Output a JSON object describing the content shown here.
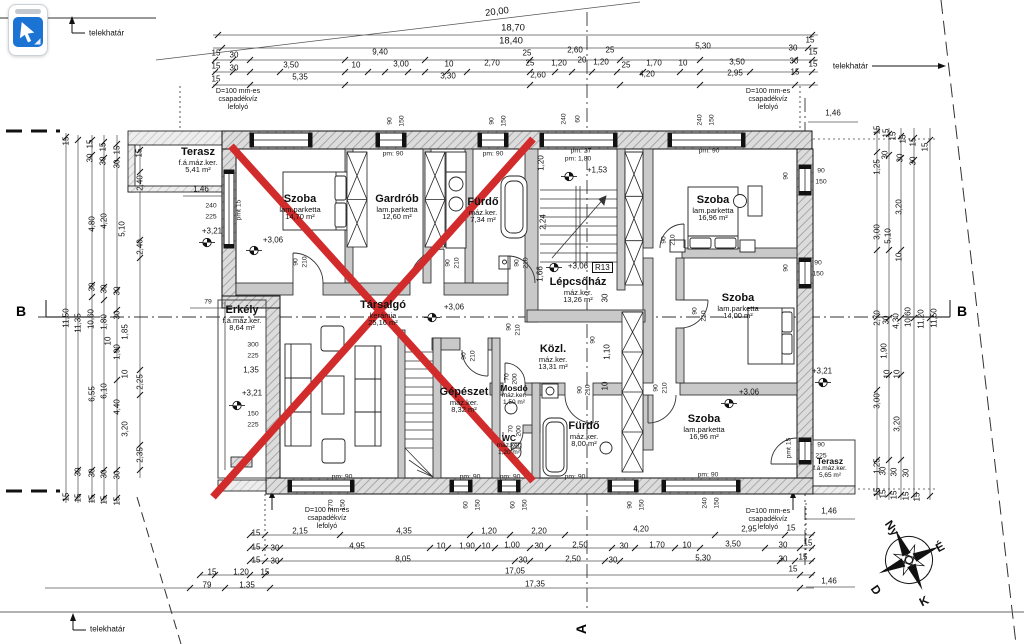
{
  "tool_button": {
    "tool": "cursor"
  },
  "labels": {
    "telekhatar": "telekhatár",
    "drain_lines": [
      "D=100 mm-es",
      "csapadékvíz",
      "lefolyó"
    ],
    "section_b": "B",
    "section_a": "A",
    "stair_code": "R13"
  },
  "compass": {
    "w": "Ny",
    "n": "É",
    "s": "D",
    "e": "K"
  },
  "colors": {
    "redx": "#d22b2b",
    "tool_blue": "#1b74d3"
  },
  "rooms": [
    {
      "n": "Terasz",
      "f": "f.á.máz.ker.",
      "a": "5,41 m²",
      "x": 198,
      "y": 147,
      "cls": ""
    },
    {
      "n": "Szoba",
      "f": "lam.parketta",
      "a": "14,70 m²",
      "x": 300,
      "y": 194,
      "cls": ""
    },
    {
      "n": "Gardrób",
      "f": "lam.parketta",
      "a": "12,60 m²",
      "x": 397,
      "y": 194,
      "cls": ""
    },
    {
      "n": "Fürdő",
      "f": "máz.ker.",
      "a": "7,34 m²",
      "x": 483,
      "y": 197,
      "cls": ""
    },
    {
      "n": "Szoba",
      "f": "lam.parketta",
      "a": "16,96 m²",
      "x": 713,
      "y": 195,
      "cls": ""
    },
    {
      "n": "Lépcsőház",
      "f": "máz.ker.",
      "a": "13,26 m²",
      "x": 578,
      "y": 277,
      "cls": ""
    },
    {
      "n": "Szoba",
      "f": "lam.parketta",
      "a": "14,00 m²",
      "x": 738,
      "y": 293,
      "cls": ""
    },
    {
      "n": "Erkély",
      "f": "f.á.máz.ker.",
      "a": "8,64 m²",
      "x": 242,
      "y": 305,
      "cls": ""
    },
    {
      "n": "Társalgó",
      "f": "kerámia",
      "a": "25,16 m²",
      "x": 383,
      "y": 300,
      "cls": ""
    },
    {
      "n": "Közl.",
      "f": "máz.ker.",
      "a": "13,31 m²",
      "x": 553,
      "y": 344,
      "cls": ""
    },
    {
      "n": "Gépészet",
      "f": "máz.ker.",
      "a": "8,32 m²",
      "x": 464,
      "y": 387,
      "cls": ""
    },
    {
      "n": "Mosdó",
      "f": "máz.ker.",
      "a": "1,50 m²",
      "x": 514,
      "y": 384,
      "cls": "small"
    },
    {
      "n": "WC",
      "f": "máz.ker.",
      "a": "1,20 m²",
      "x": 509,
      "y": 434,
      "cls": "small"
    },
    {
      "n": "Fürdő",
      "f": "máz.ker.",
      "a": "8,00 m²",
      "x": 584,
      "y": 421,
      "cls": ""
    },
    {
      "n": "Szoba",
      "f": "lam.parketta",
      "a": "16,96 m²",
      "x": 704,
      "y": 414,
      "cls": ""
    },
    {
      "n": "Terasz",
      "f": "f.á.máz.ker.",
      "a": "5,65 m²",
      "x": 830,
      "y": 457,
      "cls": "small"
    }
  ],
  "elevations": [
    {
      "t": "+3,21",
      "x": 212,
      "y": 231
    },
    {
      "t": "+3,06",
      "x": 273,
      "y": 240
    },
    {
      "t": "+1,53",
      "x": 597,
      "y": 170
    },
    {
      "t": "+3,06",
      "x": 578,
      "y": 266
    },
    {
      "t": "+3,06",
      "x": 454,
      "y": 307
    },
    {
      "t": "+3,21",
      "x": 252,
      "y": 393
    },
    {
      "t": "+3,06",
      "x": 749,
      "y": 392
    },
    {
      "t": "+3,21",
      "x": 822,
      "y": 371
    }
  ],
  "elev_markers": [
    [
      207,
      245
    ],
    [
      254,
      253
    ],
    [
      569,
      179
    ],
    [
      554,
      270
    ],
    [
      432,
      320
    ],
    [
      237,
      408
    ],
    [
      729,
      406
    ],
    [
      823,
      385
    ]
  ],
  "drains": [
    [
      238,
      88
    ],
    [
      768,
      88
    ],
    [
      327,
      507
    ],
    [
      768,
      508
    ]
  ],
  "dims": [
    [
      "20,00",
      497,
      12,
      -7,
      "big"
    ],
    [
      "18,70",
      513,
      28,
      0,
      "big"
    ],
    [
      "18,40",
      511,
      41,
      0,
      "big"
    ],
    [
      "15",
      216,
      53
    ],
    [
      "30",
      234,
      55
    ],
    [
      "9,40",
      380,
      52
    ],
    [
      "25",
      527,
      53
    ],
    [
      "2,60",
      575,
      50
    ],
    [
      "25",
      610,
      50
    ],
    [
      "5,30",
      703,
      46
    ],
    [
      "30",
      793,
      48
    ],
    [
      "15",
      810,
      40
    ],
    [
      "15",
      813,
      52
    ],
    [
      "15",
      216,
      66
    ],
    [
      "30",
      234,
      68
    ],
    [
      "3,50",
      291,
      65
    ],
    [
      "10",
      356,
      65
    ],
    [
      "3,00",
      401,
      64
    ],
    [
      "10",
      449,
      64
    ],
    [
      "2,70",
      492,
      63
    ],
    [
      "25",
      530,
      63
    ],
    [
      "1,20",
      559,
      63
    ],
    [
      "20",
      582,
      60
    ],
    [
      "1,20",
      601,
      62
    ],
    [
      "25",
      626,
      65
    ],
    [
      "1,70",
      654,
      63
    ],
    [
      "10",
      683,
      63
    ],
    [
      "3,50",
      737,
      62
    ],
    [
      "30",
      794,
      61
    ],
    [
      "15",
      813,
      64
    ],
    [
      "15",
      216,
      79
    ],
    [
      "5,35",
      300,
      77
    ],
    [
      "3,30",
      448,
      76
    ],
    [
      "2,60",
      538,
      75
    ],
    [
      "4,20",
      647,
      74
    ],
    [
      "2,95",
      735,
      73
    ],
    [
      "15",
      795,
      72
    ],
    [
      "1,46",
      833,
      113
    ],
    [
      "15",
      66,
      141,
      -90
    ],
    [
      "15",
      90,
      144,
      -90
    ],
    [
      "15",
      103,
      147,
      -90
    ],
    [
      "15",
      117,
      150,
      -90
    ],
    [
      "15",
      139,
      153,
      -90
    ],
    [
      "30",
      90,
      158,
      -90
    ],
    [
      "30",
      103,
      161,
      -90
    ],
    [
      "30",
      117,
      164,
      -90
    ],
    [
      "2,40",
      140,
      183,
      -90
    ],
    [
      "4,80",
      92,
      224,
      -90
    ],
    [
      "4,20",
      104,
      221,
      -90
    ],
    [
      "5,10",
      122,
      229,
      -90
    ],
    [
      "2,40",
      140,
      247,
      -90
    ],
    [
      "30",
      92,
      287,
      -90
    ],
    [
      "30",
      104,
      289,
      -90
    ],
    [
      "30",
      117,
      291,
      -90
    ],
    [
      "11,50",
      66,
      318,
      -90
    ],
    [
      "11,35",
      78,
      323,
      -90
    ],
    [
      "10,60",
      91,
      319,
      -90
    ],
    [
      "1,80",
      104,
      322,
      -90
    ],
    [
      "30",
      117,
      315,
      -90
    ],
    [
      "1,85",
      125,
      332,
      -90
    ],
    [
      "10",
      108,
      341,
      -90
    ],
    [
      "1,90",
      117,
      352,
      -90
    ],
    [
      "10",
      125,
      374,
      -90
    ],
    [
      "6,55",
      92,
      394,
      -90
    ],
    [
      "6,10",
      104,
      391,
      -90
    ],
    [
      "4,40",
      117,
      407,
      -90
    ],
    [
      "3,20",
      125,
      429,
      -90
    ],
    [
      "2,25",
      140,
      382,
      -90
    ],
    [
      "2,35",
      140,
      455,
      -90
    ],
    [
      "30",
      78,
      472,
      -90
    ],
    [
      "30",
      92,
      473,
      -90
    ],
    [
      "30",
      104,
      474,
      -90
    ],
    [
      "30",
      117,
      475,
      -90
    ],
    [
      "15",
      66,
      497,
      -90
    ],
    [
      "15",
      78,
      498,
      -90
    ],
    [
      "15",
      92,
      499,
      -90
    ],
    [
      "15",
      104,
      500,
      -90
    ],
    [
      "15",
      117,
      501,
      -90
    ],
    [
      "15",
      877,
      130,
      -90
    ],
    [
      "15",
      886,
      133,
      -90
    ],
    [
      "15",
      893,
      136,
      -90
    ],
    [
      "15",
      903,
      139,
      -90
    ],
    [
      "15",
      913,
      142,
      -90
    ],
    [
      "15",
      925,
      147,
      -90
    ],
    [
      "30",
      885,
      155,
      -90
    ],
    [
      "30",
      900,
      158,
      -90
    ],
    [
      "30",
      913,
      161,
      -90
    ],
    [
      "1,25",
      877,
      167,
      -90
    ],
    [
      "3,20",
      899,
      207,
      -90
    ],
    [
      "3,00",
      877,
      232,
      -90
    ],
    [
      "5,10",
      888,
      236,
      -90
    ],
    [
      "10",
      899,
      257,
      -90
    ],
    [
      "2,70",
      877,
      318,
      -90
    ],
    [
      "30",
      886,
      320,
      -90
    ],
    [
      "4,30",
      896,
      321,
      -90
    ],
    [
      "10,60",
      908,
      317,
      -90
    ],
    [
      "11,20",
      921,
      319,
      -90
    ],
    [
      "11,50",
      934,
      318,
      -90
    ],
    [
      "1,90",
      884,
      351,
      -90
    ],
    [
      "10",
      887,
      374,
      -90
    ],
    [
      "10",
      897,
      374,
      -90
    ],
    [
      "3,00",
      877,
      401,
      -90
    ],
    [
      "3,20",
      897,
      424,
      -90
    ],
    [
      "1,25",
      877,
      466,
      -90
    ],
    [
      "30",
      883,
      471,
      -90
    ],
    [
      "30",
      894,
      472,
      -90
    ],
    [
      "30",
      906,
      473,
      -90
    ],
    [
      "15",
      877,
      492,
      -90
    ],
    [
      "15",
      883,
      494,
      -90
    ],
    [
      "15",
      894,
      495,
      -90
    ],
    [
      "15",
      906,
      496,
      -90
    ],
    [
      "15",
      917,
      497,
      -90
    ],
    [
      "15",
      256,
      533
    ],
    [
      "2,15",
      300,
      531
    ],
    [
      "4,35",
      404,
      531
    ],
    [
      "1,20",
      489,
      531
    ],
    [
      "2,20",
      539,
      531
    ],
    [
      "4,20",
      641,
      529
    ],
    [
      "2,95",
      749,
      529
    ],
    [
      "15",
      791,
      528
    ],
    [
      "15",
      256,
      547
    ],
    [
      "30",
      275,
      548
    ],
    [
      "4,95",
      357,
      546
    ],
    [
      "10",
      441,
      546
    ],
    [
      "1,90",
      467,
      546
    ],
    [
      "10",
      486,
      546
    ],
    [
      "1,00",
      512,
      545
    ],
    [
      "30",
      539,
      546
    ],
    [
      "2,50",
      580,
      545
    ],
    [
      "30",
      624,
      546
    ],
    [
      "1,70",
      657,
      545
    ],
    [
      "10",
      687,
      545
    ],
    [
      "3,50",
      733,
      544
    ],
    [
      "30",
      783,
      545
    ],
    [
      "15",
      808,
      543
    ],
    [
      "15",
      256,
      560
    ],
    [
      "30",
      275,
      561
    ],
    [
      "8,05",
      403,
      559
    ],
    [
      "30",
      523,
      560
    ],
    [
      "2,50",
      573,
      559
    ],
    [
      "30",
      613,
      560
    ],
    [
      "5,30",
      703,
      558
    ],
    [
      "30",
      783,
      559
    ],
    [
      "15",
      803,
      557
    ],
    [
      "15",
      212,
      572
    ],
    [
      "1,20",
      241,
      572
    ],
    [
      "15",
      265,
      572
    ],
    [
      "17,05",
      515,
      571
    ],
    [
      "15",
      793,
      569
    ],
    [
      "79",
      207,
      585
    ],
    [
      "1,35",
      247,
      585
    ],
    [
      "17,35",
      535,
      584
    ],
    [
      "1,46",
      829,
      581
    ],
    [
      "1,46",
      829,
      511
    ],
    [
      "90",
      390,
      121,
      -90,
      "sm"
    ],
    [
      "150",
      402,
      121,
      -90,
      "sm"
    ],
    [
      "90",
      492,
      121,
      -90,
      "sm"
    ],
    [
      "150",
      504,
      121,
      -90,
      "sm"
    ],
    [
      "240",
      564,
      119,
      -90,
      "sm"
    ],
    [
      "60",
      578,
      119,
      -90,
      "sm"
    ],
    [
      "240",
      700,
      120,
      -90,
      "sm"
    ],
    [
      "150",
      712,
      120,
      -90,
      "sm"
    ],
    [
      "270",
      331,
      505,
      -90,
      "sm"
    ],
    [
      "150",
      343,
      505,
      -90,
      "sm"
    ],
    [
      "60",
      466,
      505,
      -90,
      "sm"
    ],
    [
      "150",
      478,
      505,
      -90,
      "sm"
    ],
    [
      "60",
      513,
      505,
      -90,
      "sm"
    ],
    [
      "150",
      525,
      505,
      -90,
      "sm"
    ],
    [
      "90",
      630,
      505,
      -90,
      "sm"
    ],
    [
      "150",
      642,
      505,
      -90,
      "sm"
    ],
    [
      "240",
      705,
      503,
      -90,
      "sm"
    ],
    [
      "150",
      717,
      503,
      -90,
      "sm"
    ],
    [
      "pm: 90",
      393,
      154,
      0,
      "sm"
    ],
    [
      "pm: 90",
      493,
      154,
      0,
      "sm"
    ],
    [
      "pm: 27",
      581,
      151,
      0,
      "sm"
    ],
    [
      "pm: 1,80",
      578,
      159,
      0,
      "sm"
    ],
    [
      "pm: 90",
      709,
      151,
      0,
      "sm"
    ],
    [
      "pm: 90",
      342,
      477,
      0,
      "sm"
    ],
    [
      "pm: 90",
      470,
      477,
      0,
      "sm"
    ],
    [
      "pm: 90",
      510,
      477,
      0,
      "sm"
    ],
    [
      "pm: 90",
      575,
      477,
      0,
      "sm"
    ],
    [
      "pm: 90",
      708,
      475,
      0,
      "sm"
    ],
    [
      "90",
      821,
      171,
      0,
      "sm"
    ],
    [
      "150",
      821,
      182,
      0,
      "sm"
    ],
    [
      "90",
      818,
      263,
      0,
      "sm"
    ],
    [
      "150",
      818,
      274,
      0,
      "sm"
    ],
    [
      "90",
      821,
      445,
      0,
      "sm"
    ],
    [
      "225",
      821,
      456,
      0,
      "sm"
    ],
    [
      "90",
      786,
      176,
      -90,
      "sm"
    ],
    [
      "90",
      786,
      268,
      -90,
      "sm"
    ],
    [
      "pmt 15",
      789,
      448,
      -90,
      "sm"
    ],
    [
      "240",
      211,
      206,
      0,
      "sm"
    ],
    [
      "225",
      211,
      217,
      0,
      "sm"
    ],
    [
      "pmt 15",
      239,
      210,
      -90,
      "sm"
    ],
    [
      "1,46",
      201,
      189
    ],
    [
      "79",
      208,
      302,
      0,
      "sm"
    ],
    [
      "300",
      253,
      345,
      0,
      "sm"
    ],
    [
      "225",
      253,
      356,
      0,
      "sm"
    ],
    [
      "1,35",
      251,
      370
    ],
    [
      "150",
      253,
      414,
      0,
      "sm"
    ],
    [
      "225",
      253,
      425,
      0,
      "sm"
    ],
    [
      "90",
      296,
      262,
      -90,
      "sm"
    ],
    [
      "210",
      305,
      262,
      -90,
      "sm"
    ],
    [
      "90",
      448,
      263,
      -90,
      "sm"
    ],
    [
      "210",
      457,
      263,
      -90,
      "sm"
    ],
    [
      "90",
      517,
      263,
      -90,
      "sm"
    ],
    [
      "210",
      526,
      263,
      -90,
      "sm"
    ],
    [
      "90",
      664,
      240,
      -90,
      "sm"
    ],
    [
      "210",
      673,
      240,
      -90,
      "sm"
    ],
    [
      "90",
      695,
      311,
      -90,
      "sm"
    ],
    [
      "210",
      704,
      316,
      -90,
      "sm"
    ],
    [
      "90",
      509,
      327,
      -90,
      "sm"
    ],
    [
      "210",
      518,
      330,
      -90,
      "sm"
    ],
    [
      "70",
      507,
      377,
      -90,
      "sm"
    ],
    [
      "200",
      515,
      379,
      -90,
      "sm"
    ],
    [
      "90",
      580,
      390,
      -90,
      "sm"
    ],
    [
      "210",
      588,
      390,
      -90,
      "sm"
    ],
    [
      "90",
      656,
      388,
      -90,
      "sm"
    ],
    [
      "210",
      665,
      388,
      -90,
      "sm"
    ],
    [
      "90",
      464,
      356,
      -90,
      "sm"
    ],
    [
      "210",
      473,
      356,
      -90,
      "sm"
    ],
    [
      "70",
      511,
      429,
      -90,
      "sm"
    ],
    [
      "200",
      519,
      431,
      -90,
      "sm"
    ],
    [
      "1,20",
      541,
      163,
      -90
    ],
    [
      "2,24",
      543,
      222,
      -90
    ],
    [
      "1,66",
      540,
      274,
      -90
    ],
    [
      "30",
      605,
      298,
      -90
    ],
    [
      "1,10",
      607,
      352,
      -90
    ],
    [
      "10",
      605,
      386,
      -90
    ],
    [
      "90",
      593,
      340,
      -90,
      "sm"
    ]
  ],
  "ticks": {
    "h": {
      "35": [
        218,
        812
      ],
      "48": [
        222,
        808
      ],
      "60": [
        215,
        233,
        250,
        345,
        425,
        530,
        620,
        700,
        795,
        812
      ],
      "72": [
        215,
        233,
        250,
        280,
        345,
        368,
        385,
        408,
        425,
        447,
        467,
        530,
        555,
        572,
        592,
        617,
        643,
        680,
        700,
        750,
        795,
        812
      ],
      "85": [
        215,
        250,
        345,
        530,
        620,
        700,
        795,
        812
      ],
      "535": [
        250,
        265,
        340,
        470,
        510,
        565,
        715,
        785,
        812
      ],
      "548": [
        250,
        265,
        280,
        430,
        448,
        478,
        495,
        530,
        548,
        612,
        635,
        675,
        700,
        765,
        800,
        812
      ],
      "561": [
        250,
        265,
        280,
        515,
        530,
        605,
        620,
        780,
        795,
        812
      ],
      "575": [
        200,
        215,
        250,
        265,
        800,
        812
      ],
      "588": [
        190,
        225,
        270,
        800
      ]
    },
    "v": {
      "66": [
        137,
        498
      ],
      "78": [
        140,
        470,
        497
      ],
      "92": [
        140,
        155,
        285,
        297,
        470,
        497
      ],
      "104": [
        142,
        158,
        287,
        300,
        470,
        498
      ],
      "117": [
        144,
        160,
        290,
        310,
        350,
        380,
        470,
        498
      ],
      "140": [
        150,
        172,
        240,
        258,
        370,
        395,
        445,
        470
      ],
      "877": [
        132,
        152,
        250,
        317,
        390,
        460,
        493
      ],
      "889": [
        134,
        155,
        250,
        318,
        375,
        460,
        494
      ],
      "901": [
        136,
        158,
        250,
        318,
        375,
        460,
        495
      ],
      "914": [
        138,
        160,
        318,
        495
      ],
      "930": [
        140,
        318,
        496
      ]
    }
  }
}
